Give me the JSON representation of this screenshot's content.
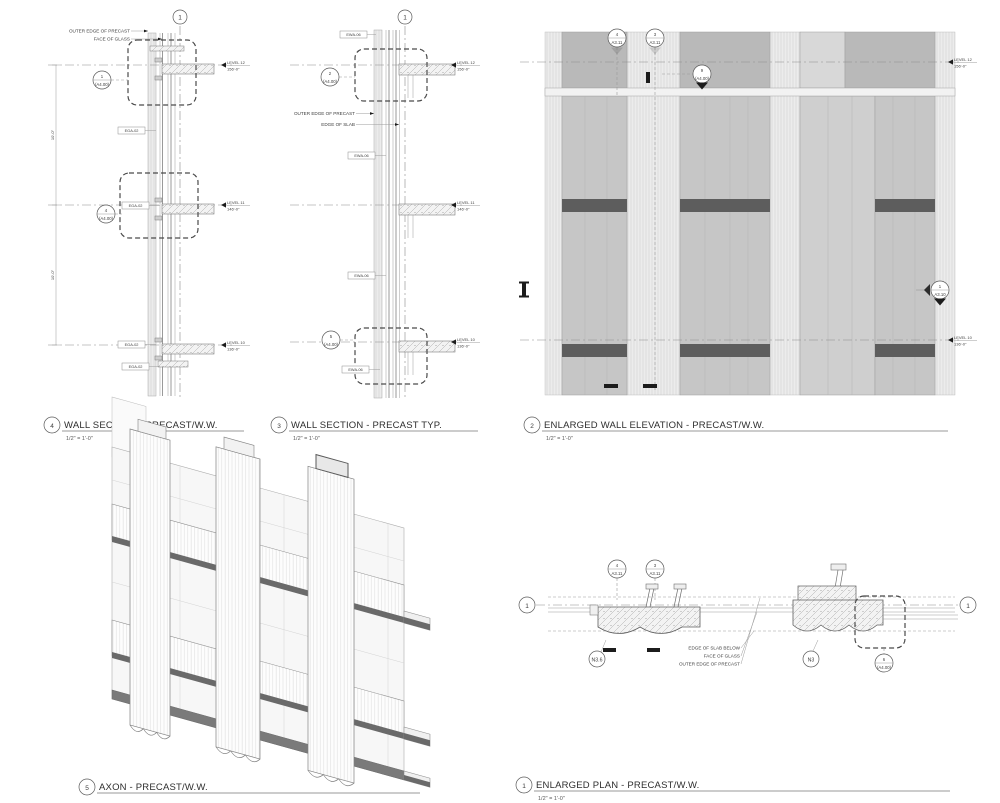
{
  "views": {
    "section_ww": {
      "title_num": "4",
      "title": "WALL SECTION - PRECAST/W.W.",
      "scale": "1/2\" = 1'-0\"",
      "grid": "1",
      "leaders": {
        "precast": "OUTER EDGE OF PRECAST",
        "glass": "FACE OF GLASS"
      },
      "callouts": [
        {
          "num": "1",
          "sheet": "(A4.00)"
        },
        {
          "num": "4",
          "sheet": "(A4.00)"
        }
      ],
      "keynote": "EGA-02",
      "levels": [
        {
          "name": "LEVEL 12",
          "elev": "156'-0\""
        },
        {
          "name": "LEVEL 11",
          "elev": "146'-0\""
        },
        {
          "name": "LEVEL 10",
          "elev": "136'-0\""
        }
      ],
      "dim": "10'-0\""
    },
    "section_typ": {
      "title_num": "3",
      "title": "WALL SECTION - PRECAST TYP.",
      "scale": "1/2\" = 1'-0\"",
      "grid": "1",
      "leaders": {
        "precast": "OUTER EDGE OF PRECAST",
        "slab": "EDGE OF SLAB"
      },
      "callouts": [
        {
          "num": "2",
          "sheet": "(A4.00)"
        },
        {
          "num": "5",
          "sheet": "(A4.00)"
        }
      ],
      "keynote": "EWA-06",
      "levels": [
        {
          "name": "LEVEL 12",
          "elev": "156'-0\""
        },
        {
          "name": "LEVEL 11",
          "elev": "146'-0\""
        },
        {
          "name": "LEVEL 10",
          "elev": "136'-0\""
        }
      ]
    },
    "elevation": {
      "title_num": "2",
      "title": "ENLARGED WALL ELEVATION - PRECAST/W.W.",
      "scale": "1/2\" = 1'-0\"",
      "markers": [
        {
          "num": "4",
          "sheet": "A3.11"
        },
        {
          "num": "3",
          "sheet": "A3.11"
        }
      ],
      "callout": {
        "num": "9",
        "sheet": "(A4.00)"
      },
      "section_cut": {
        "num": "1",
        "sheet": "A3.10"
      },
      "levels": [
        {
          "name": "LEVEL 12",
          "elev": "156'-0\""
        },
        {
          "name": "LEVEL 10",
          "elev": "136'-0\""
        }
      ]
    },
    "axon": {
      "title_num": "5",
      "title": "AXON - PRECAST/W.W."
    },
    "plan": {
      "title_num": "1",
      "title": "ENLARGED PLAN - PRECAST/W.W.",
      "scale": "1/2\" = 1'-0\"",
      "grid_left": "1",
      "grid_right": "1",
      "markers": [
        {
          "num": "4",
          "sheet": "A3.11"
        },
        {
          "num": "3",
          "sheet": "A3.11"
        }
      ],
      "grids": {
        "n36": "N3.6",
        "n3": "N3"
      },
      "callout": {
        "num": "6",
        "sheet": "(A4.00)"
      },
      "leaders": {
        "slab": "EDGE OF SLAB BELOW",
        "glass": "FACE OF GLASS",
        "precast": "OUTER EDGE OF PRECAST"
      }
    }
  },
  "colors": {
    "panel": "#c6c6c6",
    "panel_dark": "#b9b9b9",
    "flute": "#ececec",
    "band": "#5d5d5d",
    "ink": "#3d3d3d"
  }
}
